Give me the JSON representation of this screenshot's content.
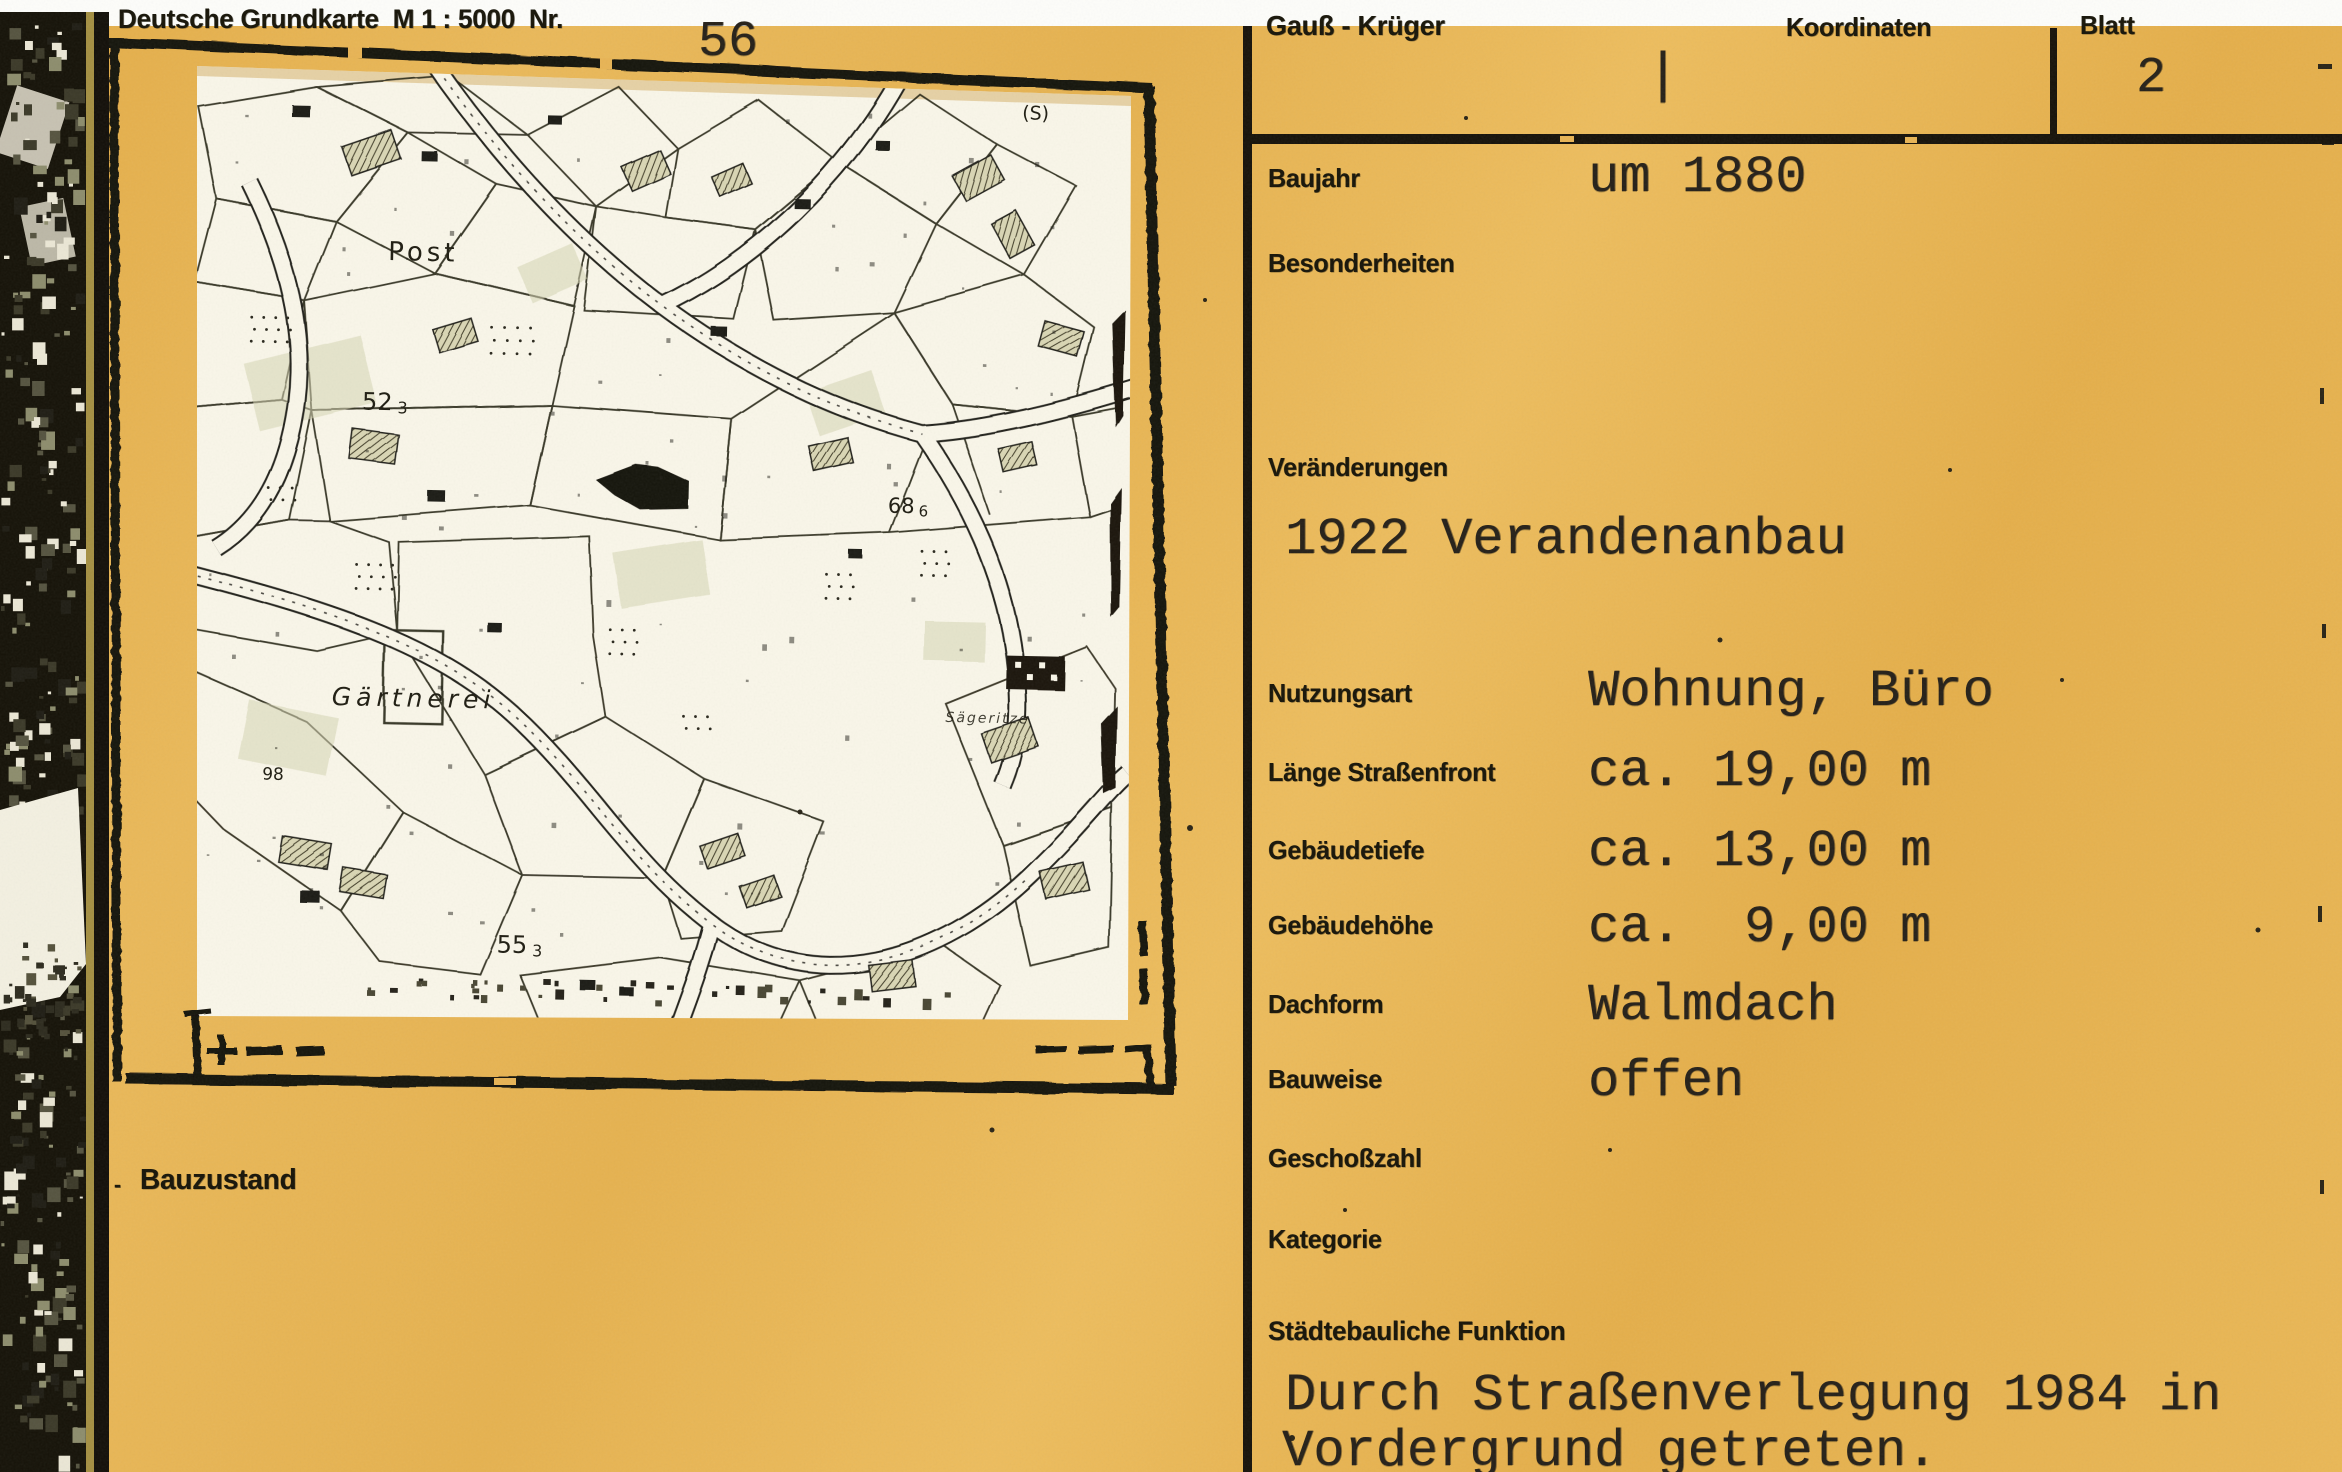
{
  "colors": {
    "card_yellow": "#e8b455",
    "ink": "#17130b",
    "map_paper": "#f9f6e9"
  },
  "map_card": {
    "header_label": "Deutsche Grundkarte  M 1 : 5000  Nr.",
    "header_number": "56",
    "bauzustand": {
      "dash": "-",
      "label": "Bauzustand"
    },
    "map": {
      "labels": {
        "post": "Post",
        "gaertnerei": "Gärtnerei",
        "street_label": "Sägeritze",
        "num_98": "98",
        "s_mark": "(S)",
        "elev_52": {
          "main": "52",
          "sub": "3"
        },
        "elev_55": {
          "main": "55",
          "sub": "3"
        },
        "elev_68": {
          "main": "68",
          "sub": "6"
        }
      }
    }
  },
  "details_panel": {
    "header": {
      "gauss_krueger": "Gauß - Krüger",
      "coordinate_tick": "|",
      "koordinaten": "Koordinaten",
      "blatt": "Blatt",
      "blatt_number": "2"
    },
    "fields": [
      {
        "label": "Baujahr",
        "value": "um 1880"
      },
      {
        "label": "Besonderheiten",
        "value": ""
      },
      {
        "label": "Veränderungen",
        "value": "1922 Verandenanbau"
      },
      {
        "label": "Nutzungsart",
        "value": "Wohnung, Büro"
      },
      {
        "label": "Länge Straßenfront",
        "value": "ca. 19,00 m"
      },
      {
        "label": "Gebäudetiefe",
        "value": "ca. 13,00 m"
      },
      {
        "label": "Gebäudehöhe",
        "value": "ca.  9,00 m"
      },
      {
        "label": "Dachform",
        "value": "Walmdach"
      },
      {
        "label": "Bauweise",
        "value": "offen"
      },
      {
        "label": "Geschoßzahl",
        "value": ""
      },
      {
        "label": "Kategorie",
        "value": ""
      },
      {
        "label": "Städtebauliche Funktion",
        "value_line1": "Durch Straßenverlegung 1984 in",
        "value_line2": "Vordergrund getreten."
      }
    ]
  }
}
